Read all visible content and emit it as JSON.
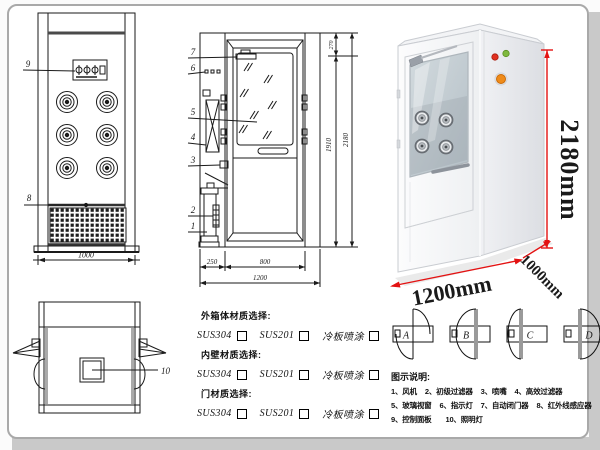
{
  "drawing": {
    "front_view": {
      "callout_control_panel": "9",
      "callout_sensor": "8",
      "dim_width": "1000"
    },
    "side_view": {
      "callout_door_closer": "7",
      "callout_indicator": "6",
      "callout_glass": "5",
      "callout_hepa": "4",
      "callout_nozzle": "3",
      "callout_prefilter": "2",
      "callout_fan": "1",
      "dim_top": "270",
      "dim_door_height": "1910",
      "dim_total_height": "2180",
      "dim_left_depth": "250",
      "dim_door_width": "800",
      "dim_total_width": "1200"
    },
    "top_view": {
      "callout_lamp": "10"
    }
  },
  "photo": {
    "dim_height": "2180mm",
    "dim_width": "1200mm",
    "dim_depth": "1000mm"
  },
  "materials": {
    "groups": [
      {
        "title": "外箱体材质选择:",
        "options": [
          "SUS304",
          "SUS201",
          "冷板喷涂"
        ]
      },
      {
        "title": "内壁材质选择:",
        "options": [
          "SUS304",
          "SUS201",
          "冷板喷涂"
        ]
      },
      {
        "title": "门材质选择:",
        "options": [
          "SUS304",
          "SUS201",
          "冷板喷涂"
        ]
      }
    ]
  },
  "door_options": {
    "labels": [
      "A",
      "B",
      "C",
      "D"
    ]
  },
  "legend": {
    "title": "图示说明:",
    "rows": [
      [
        "1、风机",
        "2、初级过滤器",
        "3、喷嘴",
        "4、高效过滤器"
      ],
      [
        "5、玻璃视窗",
        "6、指示灯",
        "7、自动闭门器",
        "8、红外线感应器"
      ],
      [
        "9、控制面板",
        "10、照明灯"
      ]
    ]
  },
  "colors": {
    "dim_red": "#e31212",
    "line": "#1a1a1a"
  }
}
